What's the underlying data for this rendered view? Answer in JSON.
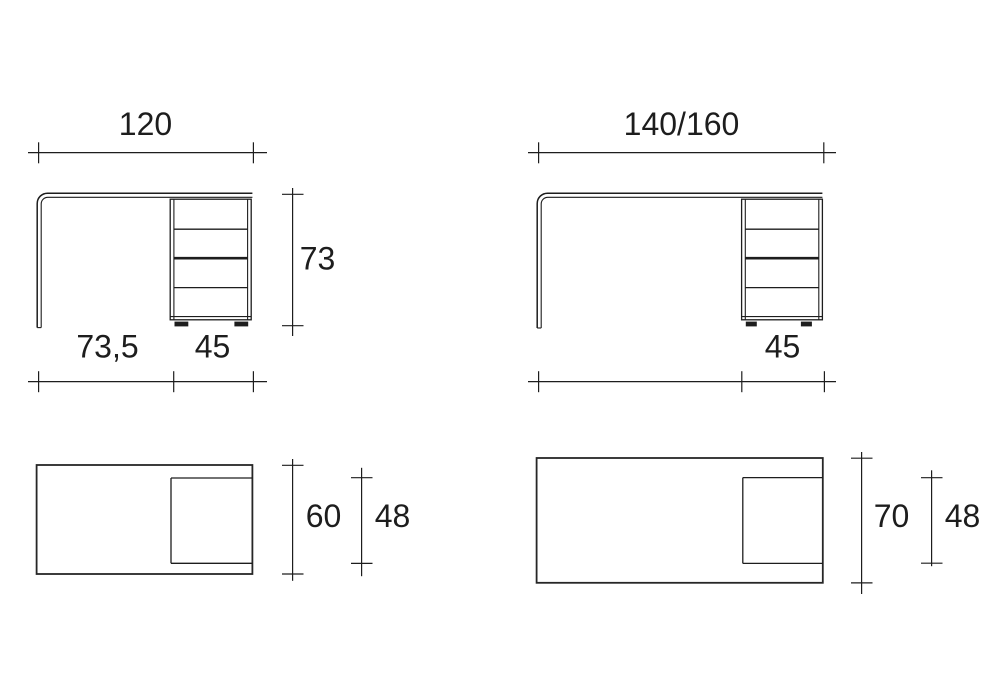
{
  "drawing": {
    "background": "#ffffff",
    "line_color": "#1d1d1d",
    "text_color": "#1d1d1d",
    "views": {
      "desk_120_front": {
        "description": "front elevation of desk with 4-drawer unit, width 120",
        "overall_width": "120",
        "overall_height": "73",
        "worktop_clear_width": "73,5",
        "drawer_unit_width": "45"
      },
      "desk_140_160_front": {
        "description": "front elevation of desk with 4-drawer unit, width 140 or 160",
        "overall_width": "140/160",
        "drawer_unit_width": "45"
      },
      "desk_120_plan": {
        "description": "plan (top) view of 120 desk",
        "overall_depth": "60",
        "drawer_unit_depth": "48"
      },
      "desk_140_160_plan": {
        "description": "plan (top) view of 140/160 desk",
        "overall_depth": "70",
        "drawer_unit_depth": "48"
      }
    }
  }
}
